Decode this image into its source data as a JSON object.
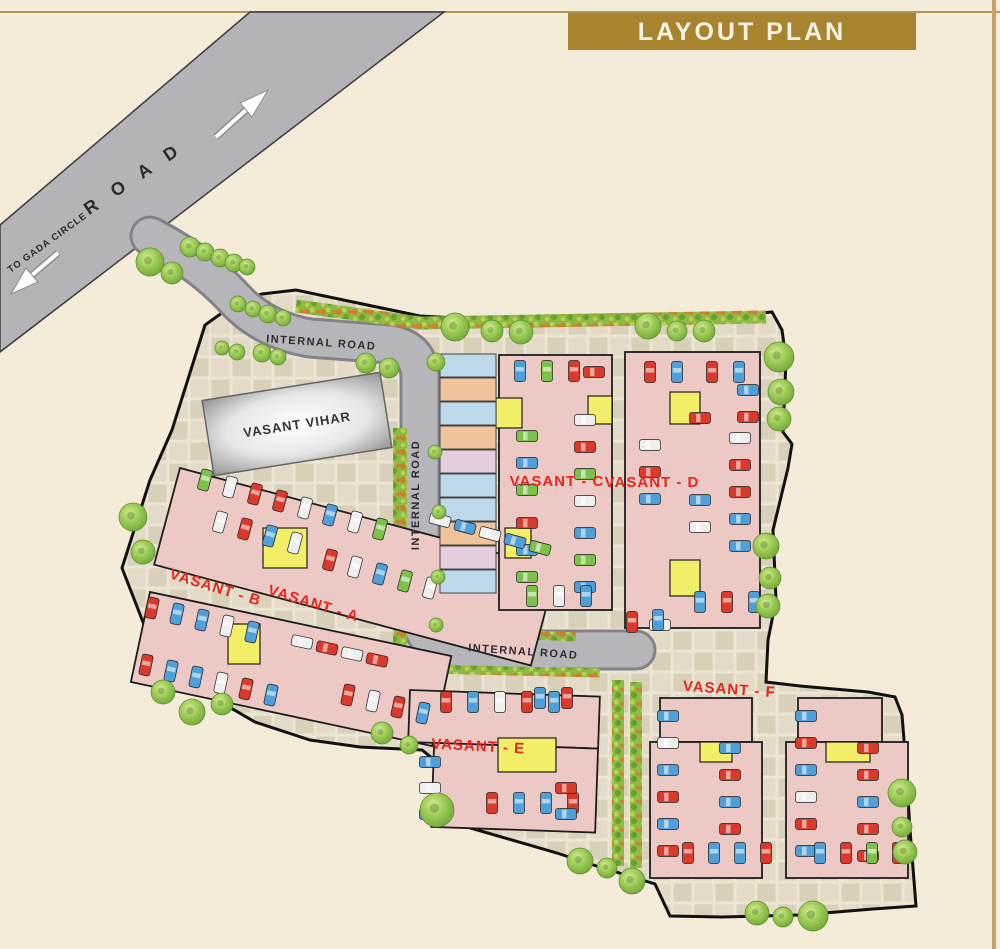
{
  "title": "LAYOUT PLAN",
  "road": {
    "name": "R O A D",
    "direction": "TO GADA CIRCLE",
    "internal": "INTERNAL ROAD"
  },
  "site": {
    "vihar": "VASANT VIHAR",
    "blocks": [
      {
        "id": "A",
        "label": "VASANT - A"
      },
      {
        "id": "B",
        "label": "VASANT - B"
      },
      {
        "id": "C",
        "label": "VASANT - C"
      },
      {
        "id": "D",
        "label": "VASANT - D"
      },
      {
        "id": "E",
        "label": "VASANT - E"
      },
      {
        "id": "F",
        "label": "VASANT - F"
      }
    ]
  },
  "palette": {
    "background": "#f4ebd8",
    "banner": "#a8842f",
    "banner_text": "#f7f2e6",
    "rule_line": "#b09a58",
    "road": "#b4b3b8",
    "road_edge": "#3c3c40",
    "internal_road": "#b6b5ba",
    "internal_road_edge": "#838289",
    "paver_base": "#ece5d3",
    "paver_tile": "#d9d0ba",
    "boundary": "#111111",
    "building": "#ecc9c5",
    "building_edge": "#1d1d1d",
    "stair_core": "#f3ee68",
    "label_red": "#e8251c",
    "label_dark": "#2b2b2b",
    "tree": "#8cbb4a",
    "hedge": "#8cba45",
    "vihar_gray": "#8f8f90",
    "cars": {
      "red": "#d93a2b",
      "blue": "#4f9fd8",
      "green": "#7cc24a",
      "white": "#efefef",
      "yellow": "#e3d34a",
      "dark": "#3f3f46"
    },
    "shops": {
      "blue": "#bcd8ea",
      "peach": "#efc49c",
      "mauve": "#e3cede"
    }
  },
  "structures": [
    {
      "id": "A",
      "rot": 15,
      "px": 180,
      "py": 468,
      "rects": [
        [
          180,
          468,
          390,
          100
        ]
      ],
      "cores": [
        [
          263,
          528,
          44,
          40
        ]
      ]
    },
    {
      "id": "B",
      "rot": 12,
      "px": 150,
      "py": 592,
      "rects": [
        [
          150,
          592,
          308,
          92
        ]
      ],
      "cores": [
        [
          228,
          624,
          32,
          40
        ]
      ]
    },
    {
      "id": "C",
      "rot": 0,
      "px": 0,
      "py": 0,
      "rects": [
        [
          499,
          355,
          113,
          255
        ]
      ],
      "cores": [
        [
          496,
          398,
          26,
          30
        ],
        [
          588,
          396,
          24,
          28
        ],
        [
          505,
          528,
          26,
          30
        ]
      ]
    },
    {
      "id": "D",
      "rot": 0,
      "px": 0,
      "py": 0,
      "rects": [
        [
          625,
          352,
          135,
          276
        ]
      ],
      "cores": [
        [
          670,
          392,
          30,
          32
        ],
        [
          670,
          560,
          30,
          36
        ]
      ]
    },
    {
      "id": "E",
      "rot": 2,
      "px": 410,
      "py": 690,
      "rects": [
        [
          410,
          690,
          190,
          52
        ],
        [
          436,
          742,
          164,
          84
        ]
      ],
      "cores": [
        [
          498,
          738,
          58,
          34
        ]
      ]
    },
    {
      "id": "F1",
      "rot": 0,
      "px": 0,
      "py": 0,
      "rects": [
        [
          660,
          698,
          92,
          44
        ],
        [
          650,
          742,
          112,
          136
        ]
      ],
      "cores": [
        [
          700,
          742,
          32,
          20
        ]
      ]
    },
    {
      "id": "F2",
      "rot": 0,
      "px": 0,
      "py": 0,
      "rects": [
        [
          798,
          698,
          84,
          44
        ],
        [
          786,
          742,
          122,
          136
        ]
      ],
      "cores": [
        [
          826,
          742,
          44,
          20
        ]
      ]
    }
  ],
  "shops": {
    "x": 440,
    "y": 354,
    "w": 56,
    "h": 23,
    "gap": 1,
    "colors": [
      "blue",
      "peach",
      "blue",
      "peach",
      "mauve",
      "blue",
      "blue",
      "peach",
      "mauve",
      "blue"
    ]
  },
  "hedges": [
    {
      "d": "M296,306 L420,323 L766,317",
      "w": 13
    },
    {
      "d": "M400,428 L400,652",
      "w": 14
    },
    {
      "d": "M446,631 L576,637",
      "w": 9
    },
    {
      "d": "M424,669 L600,673",
      "w": 9
    },
    {
      "d": "M618,680 L618,866",
      "w": 12
    },
    {
      "d": "M636,682 L636,868",
      "w": 12
    }
  ],
  "trees": [
    [
      150,
      262,
      14
    ],
    [
      172,
      273,
      11
    ],
    [
      190,
      247,
      10
    ],
    [
      205,
      252,
      9
    ],
    [
      220,
      258,
      9
    ],
    [
      234,
      263,
      9
    ],
    [
      247,
      267,
      8
    ],
    [
      238,
      304,
      8
    ],
    [
      253,
      309,
      8
    ],
    [
      268,
      314,
      9
    ],
    [
      283,
      318,
      8
    ],
    [
      222,
      348,
      7
    ],
    [
      237,
      352,
      8
    ],
    [
      262,
      353,
      9
    ],
    [
      278,
      357,
      8
    ],
    [
      366,
      363,
      10
    ],
    [
      389,
      368,
      10
    ],
    [
      436,
      362,
      9
    ],
    [
      455,
      327,
      14
    ],
    [
      492,
      331,
      11
    ],
    [
      521,
      332,
      12
    ],
    [
      648,
      326,
      13
    ],
    [
      677,
      331,
      10
    ],
    [
      704,
      331,
      11
    ],
    [
      779,
      357,
      15
    ],
    [
      781,
      392,
      13
    ],
    [
      779,
      419,
      12
    ],
    [
      766,
      546,
      13
    ],
    [
      770,
      578,
      11
    ],
    [
      768,
      606,
      12
    ],
    [
      133,
      517,
      14
    ],
    [
      143,
      552,
      12
    ],
    [
      163,
      692,
      12
    ],
    [
      192,
      712,
      13
    ],
    [
      222,
      704,
      11
    ],
    [
      382,
      733,
      11
    ],
    [
      409,
      745,
      9
    ],
    [
      437,
      810,
      17
    ],
    [
      580,
      861,
      13
    ],
    [
      607,
      868,
      10
    ],
    [
      632,
      881,
      13
    ],
    [
      757,
      913,
      12
    ],
    [
      783,
      917,
      10
    ],
    [
      813,
      916,
      15
    ],
    [
      902,
      793,
      14
    ],
    [
      902,
      827,
      10
    ],
    [
      905,
      852,
      12
    ],
    [
      435,
      452,
      7
    ],
    [
      439,
      512,
      7
    ],
    [
      438,
      577,
      7
    ],
    [
      436,
      625,
      7
    ]
  ],
  "car_rows": [
    {
      "x": 520,
      "y": 371,
      "dx": 27,
      "dy": 0,
      "n": 3,
      "rot": 90,
      "colors": [
        "blue",
        "green",
        "red"
      ]
    },
    {
      "x": 594,
      "y": 372,
      "dx": 0,
      "dy": 0,
      "n": 1,
      "rot": 0,
      "colors": [
        "red"
      ]
    },
    {
      "x": 527,
      "y": 436,
      "dx": 0,
      "dy": 27,
      "n": 3,
      "rot": 0,
      "colors": [
        "green",
        "blue",
        "green"
      ]
    },
    {
      "x": 585,
      "y": 420,
      "dx": 0,
      "dy": 27,
      "n": 4,
      "rot": 0,
      "colors": [
        "white",
        "red",
        "green",
        "white"
      ]
    },
    {
      "x": 527,
      "y": 523,
      "dx": 0,
      "dy": 27,
      "n": 3,
      "rot": 0,
      "colors": [
        "red",
        "blue",
        "green"
      ]
    },
    {
      "x": 585,
      "y": 533,
      "dx": 0,
      "dy": 27,
      "n": 3,
      "rot": 0,
      "colors": [
        "blue",
        "green",
        "blue"
      ]
    },
    {
      "x": 532,
      "y": 596,
      "dx": 27,
      "dy": 0,
      "n": 3,
      "rot": 90,
      "colors": [
        "green",
        "white",
        "blue"
      ]
    },
    {
      "x": 650,
      "y": 372,
      "dx": 27,
      "dy": 0,
      "n": 2,
      "rot": 90,
      "colors": [
        "red",
        "blue"
      ]
    },
    {
      "x": 712,
      "y": 372,
      "dx": 27,
      "dy": 0,
      "n": 2,
      "rot": 90,
      "colors": [
        "red",
        "blue"
      ]
    },
    {
      "x": 748,
      "y": 390,
      "dx": 0,
      "dy": 27,
      "n": 2,
      "rot": 0,
      "colors": [
        "blue",
        "red"
      ]
    },
    {
      "x": 700,
      "y": 418,
      "dx": 0,
      "dy": 0,
      "n": 1,
      "rot": 0,
      "colors": [
        "red"
      ]
    },
    {
      "x": 740,
      "y": 438,
      "dx": 0,
      "dy": 27,
      "n": 5,
      "rot": 0,
      "colors": [
        "white",
        "red",
        "red",
        "blue",
        "blue"
      ]
    },
    {
      "x": 650,
      "y": 445,
      "dx": 0,
      "dy": 27,
      "n": 3,
      "rot": 0,
      "colors": [
        "white",
        "red",
        "blue"
      ]
    },
    {
      "x": 700,
      "y": 500,
      "dx": 0,
      "dy": 27,
      "n": 2,
      "rot": 0,
      "colors": [
        "blue",
        "white"
      ]
    },
    {
      "x": 700,
      "y": 602,
      "dx": 27,
      "dy": 0,
      "n": 3,
      "rot": 90,
      "colors": [
        "blue",
        "red",
        "blue"
      ]
    },
    {
      "x": 660,
      "y": 625,
      "dx": 0,
      "dy": 0,
      "n": 1,
      "rot": 0,
      "colors": [
        "white"
      ]
    },
    {
      "x": 632,
      "y": 622,
      "dx": 26,
      "dy": -2,
      "n": 2,
      "rot": 90,
      "colors": [
        "red",
        "blue"
      ]
    },
    {
      "x": 205,
      "y": 480,
      "dx": 25,
      "dy": 7,
      "n": 8,
      "rot": 105,
      "colors": [
        "green",
        "white",
        "red",
        "red",
        "white",
        "blue",
        "white",
        "green"
      ]
    },
    {
      "x": 220,
      "y": 522,
      "dx": 25,
      "dy": 7,
      "n": 4,
      "rot": 105,
      "colors": [
        "white",
        "red",
        "blue",
        "white"
      ]
    },
    {
      "x": 440,
      "y": 520,
      "dx": 25,
      "dy": 7,
      "n": 5,
      "rot": 15,
      "colors": [
        "white",
        "blue",
        "white",
        "blue",
        "green"
      ]
    },
    {
      "x": 330,
      "y": 560,
      "dx": 25,
      "dy": 7,
      "n": 5,
      "rot": 105,
      "colors": [
        "red",
        "white",
        "blue",
        "green",
        "white"
      ]
    },
    {
      "x": 152,
      "y": 608,
      "dx": 25,
      "dy": 6,
      "n": 5,
      "rot": 102,
      "colors": [
        "red",
        "blue",
        "blue",
        "white",
        "blue"
      ]
    },
    {
      "x": 146,
      "y": 665,
      "dx": 25,
      "dy": 6,
      "n": 6,
      "rot": 102,
      "colors": [
        "red",
        "blue",
        "blue",
        "white",
        "red",
        "blue"
      ]
    },
    {
      "x": 302,
      "y": 642,
      "dx": 25,
      "dy": 6,
      "n": 4,
      "rot": 12,
      "colors": [
        "white",
        "red",
        "white",
        "red"
      ]
    },
    {
      "x": 348,
      "y": 695,
      "dx": 25,
      "dy": 6,
      "n": 4,
      "rot": 102,
      "colors": [
        "red",
        "white",
        "red",
        "blue"
      ]
    },
    {
      "x": 446,
      "y": 702,
      "dx": 27,
      "dy": 0,
      "n": 5,
      "rot": 90,
      "colors": [
        "red",
        "blue",
        "white",
        "red",
        "blue"
      ]
    },
    {
      "x": 540,
      "y": 698,
      "dx": 27,
      "dy": 0,
      "n": 2,
      "rot": 90,
      "colors": [
        "blue",
        "red"
      ]
    },
    {
      "x": 430,
      "y": 762,
      "dx": 0,
      "dy": 26,
      "n": 3,
      "rot": 0,
      "colors": [
        "blue",
        "white",
        "blue"
      ]
    },
    {
      "x": 492,
      "y": 803,
      "dx": 27,
      "dy": 0,
      "n": 4,
      "rot": 90,
      "colors": [
        "red",
        "blue",
        "blue",
        "red"
      ]
    },
    {
      "x": 566,
      "y": 788,
      "dx": 0,
      "dy": 26,
      "n": 2,
      "rot": 0,
      "colors": [
        "red",
        "blue"
      ]
    },
    {
      "x": 668,
      "y": 716,
      "dx": 0,
      "dy": 27,
      "n": 6,
      "rot": 0,
      "colors": [
        "blue",
        "white",
        "blue",
        "red",
        "blue",
        "red"
      ]
    },
    {
      "x": 730,
      "y": 748,
      "dx": 0,
      "dy": 27,
      "n": 4,
      "rot": 0,
      "colors": [
        "blue",
        "red",
        "blue",
        "red"
      ]
    },
    {
      "x": 688,
      "y": 853,
      "dx": 26,
      "dy": 0,
      "n": 4,
      "rot": 90,
      "colors": [
        "red",
        "blue",
        "blue",
        "red"
      ]
    },
    {
      "x": 806,
      "y": 716,
      "dx": 0,
      "dy": 27,
      "n": 6,
      "rot": 0,
      "colors": [
        "blue",
        "red",
        "blue",
        "white",
        "red",
        "blue"
      ]
    },
    {
      "x": 868,
      "y": 748,
      "dx": 0,
      "dy": 27,
      "n": 5,
      "rot": 0,
      "colors": [
        "red",
        "red",
        "blue",
        "red",
        "red"
      ]
    },
    {
      "x": 820,
      "y": 853,
      "dx": 26,
      "dy": 0,
      "n": 4,
      "rot": 90,
      "colors": [
        "blue",
        "red",
        "green",
        "red"
      ]
    }
  ]
}
